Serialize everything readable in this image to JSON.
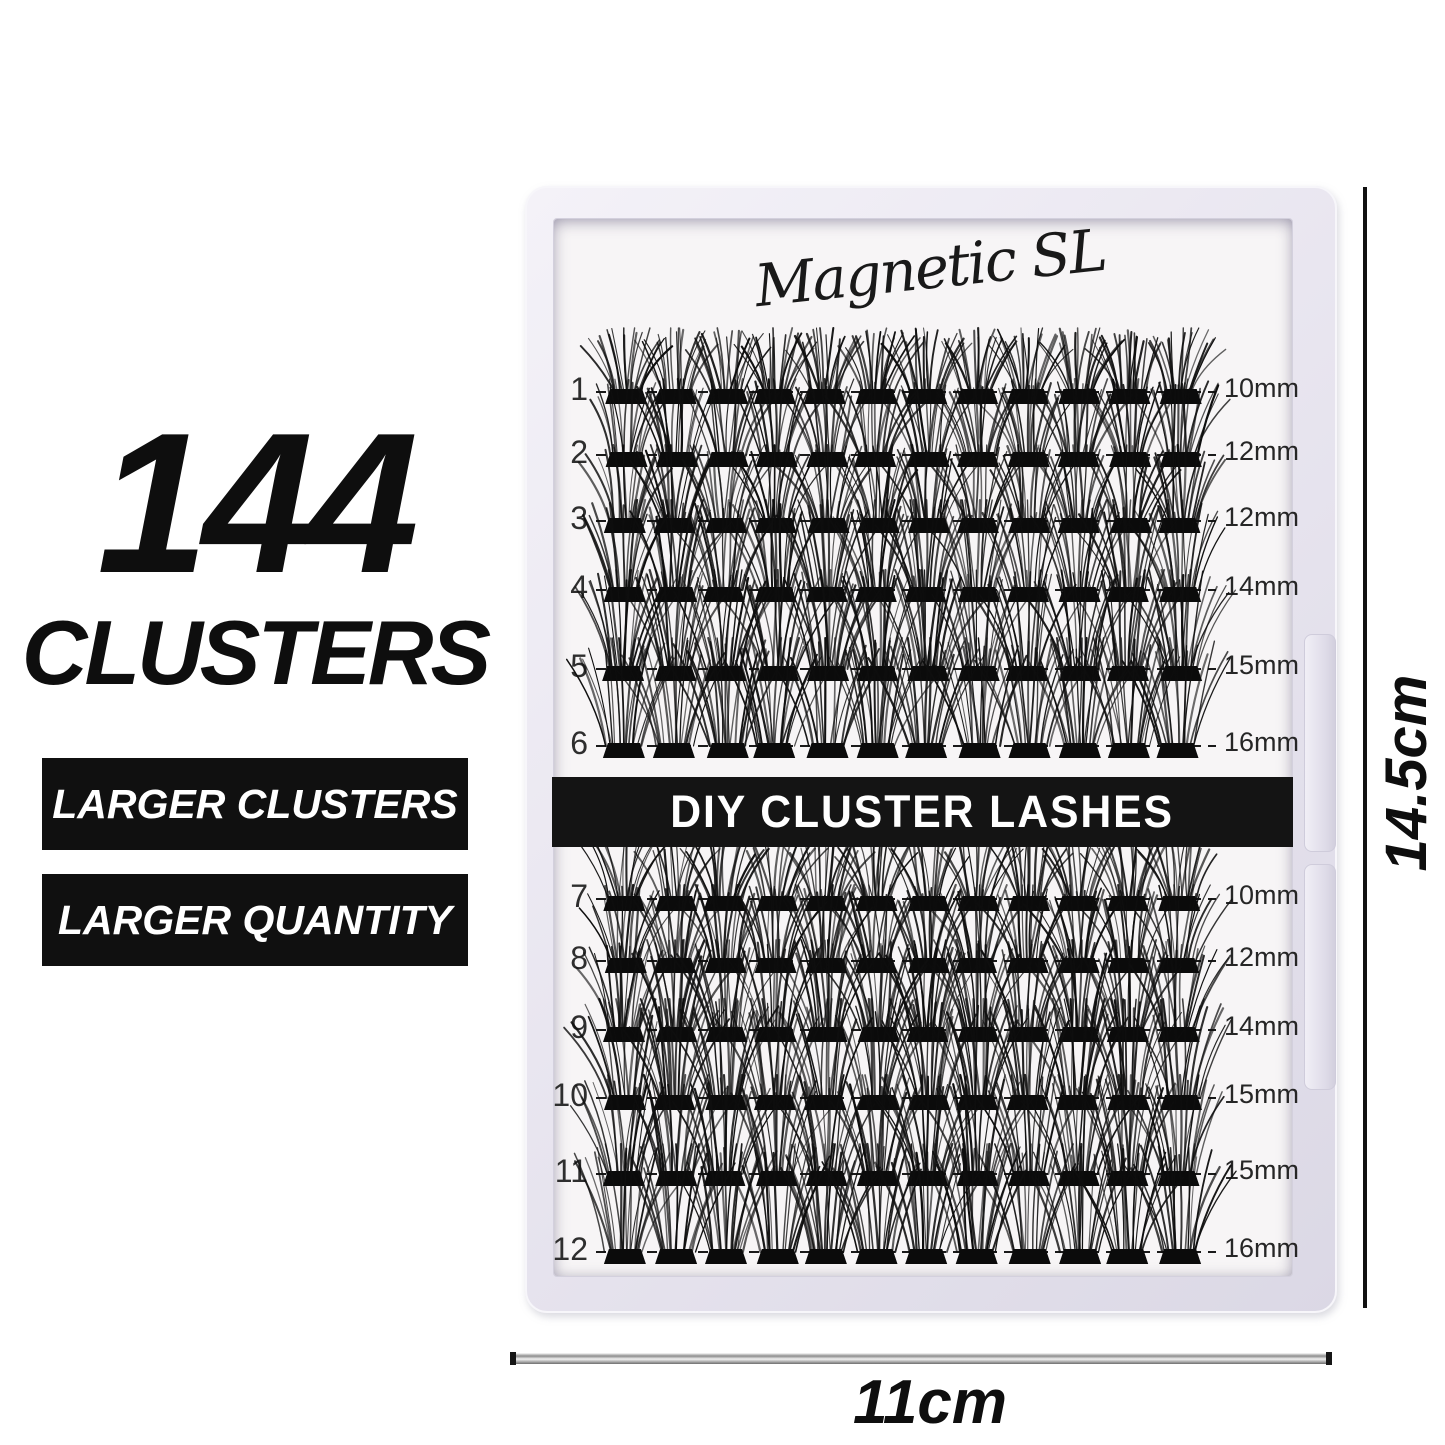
{
  "left_panel": {
    "count": "144",
    "count_label": "CLUSTERS",
    "badges": [
      {
        "label": "LARGER CLUSTERS"
      },
      {
        "label": "LARGER QUANTITY"
      }
    ],
    "badge_bg": "#101010",
    "badge_text_color": "#ffffff"
  },
  "tray": {
    "brand": "Magnetic SL",
    "banner": "DIY CLUSTER LASHES",
    "banner_bg": "#141414",
    "clusters_per_row": 12,
    "rows": [
      {
        "number": "1",
        "length": "10mm"
      },
      {
        "number": "2",
        "length": "12mm"
      },
      {
        "number": "3",
        "length": "12mm"
      },
      {
        "number": "4",
        "length": "14mm"
      },
      {
        "number": "5",
        "length": "15mm"
      },
      {
        "number": "6",
        "length": "16mm"
      },
      {
        "number": "7",
        "length": "10mm"
      },
      {
        "number": "8",
        "length": "12mm"
      },
      {
        "number": "9",
        "length": "14mm"
      },
      {
        "number": "10",
        "length": "15mm"
      },
      {
        "number": "11",
        "length": "15mm"
      },
      {
        "number": "12",
        "length": "16mm"
      }
    ]
  },
  "dimensions": {
    "height_label": "14.5cm",
    "width_label": "11cm"
  },
  "colors": {
    "lash": "#0e0e0e",
    "tray_frame": "#e3e0eb",
    "tray_surface": "#f7f5f6",
    "text": "#0e0e0e"
  }
}
